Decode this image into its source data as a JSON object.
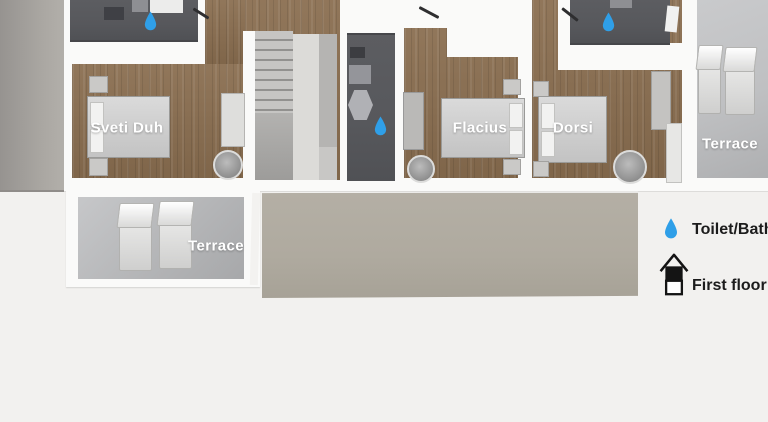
{
  "rooms": {
    "sveti_duh": {
      "label": "Sveti Duh"
    },
    "flacius": {
      "label": "Flacius"
    },
    "dorsi": {
      "label": "Dorsi"
    },
    "terrace_upper": {
      "label": "Terrace"
    },
    "terrace_lower": {
      "label": "Terrace"
    }
  },
  "legend": {
    "items": [
      {
        "icon": "water-drop",
        "label": "Toilet/Bath"
      },
      {
        "icon": "first-floor-house",
        "label": "First floor"
      }
    ]
  },
  "icons": {
    "water_drop": "teardrop",
    "first_floor_house": "two-storey house outline with upper storey filled"
  },
  "water_drop_markers_on_plan": 3,
  "colors": {
    "background": "#f2f1ef",
    "wall": "#fafaf9",
    "wood_floor": "#8a6e50",
    "bathroom_floor": "#57585c",
    "terrace_floor": "#bfc0c2",
    "roof_bottom": "#afaa9f",
    "water_drop": "#2f9fe8",
    "room_label": "#ffffff",
    "legend_text": "#1c1c1c",
    "stair_light": "#dcdbd8"
  }
}
